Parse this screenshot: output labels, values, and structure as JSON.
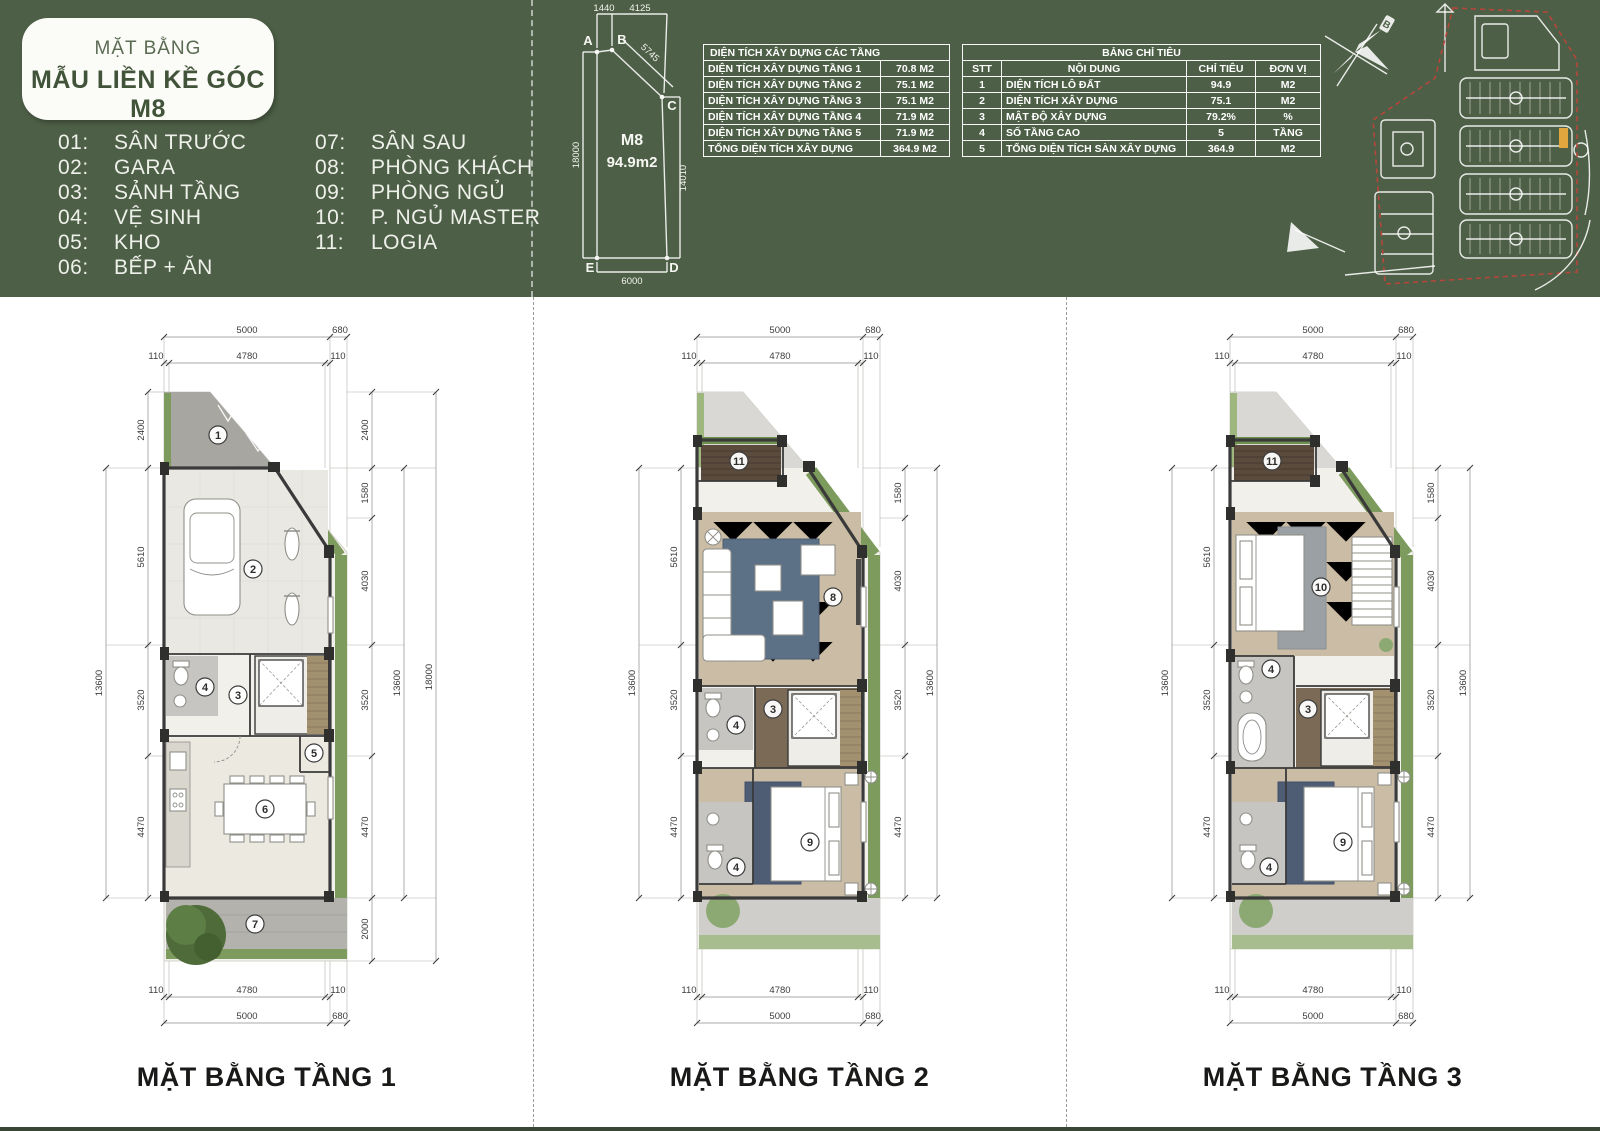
{
  "header": {
    "title_small": "MẶT BẰNG",
    "title_main": "MẪU LIỀN KỀ GÓC M8",
    "legend": [
      {
        "num": "01:",
        "label": "SÂN TRƯỚC"
      },
      {
        "num": "02:",
        "label": "GARA"
      },
      {
        "num": "03:",
        "label": "SẢNH TẦNG"
      },
      {
        "num": "04:",
        "label": "VỆ SINH"
      },
      {
        "num": "05:",
        "label": "KHO"
      },
      {
        "num": "06:",
        "label": "BẾP + ĂN"
      },
      {
        "num": "07:",
        "label": "SÂN SAU"
      },
      {
        "num": "08:",
        "label": "PHÒNG KHÁCH"
      },
      {
        "num": "09:",
        "label": "PHÒNG NGỦ"
      },
      {
        "num": "10:",
        "label": "P. NGỦ MASTER"
      },
      {
        "num": "11:",
        "label": "LOGIA"
      }
    ],
    "lot": {
      "code": "M8",
      "area": "94.9m2",
      "pA": "A",
      "pB": "B",
      "pC": "C",
      "pD": "D",
      "pE": "E",
      "d_top1": "1440",
      "d_top2": "4125",
      "d_diag": "5745",
      "d_left": "18000",
      "d_right": "14010",
      "d_bottom": "6000"
    },
    "area_table": {
      "title": "DIỆN TÍCH XÂY DỰNG CÁC TẦNG",
      "rows": [
        [
          "DIỆN TÍCH XÂY DỰNG TẦNG 1",
          "70.8 M2"
        ],
        [
          "DIỆN TÍCH XÂY DỰNG TẦNG 2",
          "75.1 M2"
        ],
        [
          "DIỆN TÍCH XÂY DỰNG TẦNG 3",
          "75.1 M2"
        ],
        [
          "DIỆN TÍCH XÂY DỰNG TẦNG 4",
          "71.9 M2"
        ],
        [
          "DIỆN TÍCH XÂY DỰNG TẦNG 5",
          "71.9 M2"
        ],
        [
          "TỔNG DIỆN TÍCH XÂY DỰNG",
          "364.9 M2"
        ]
      ]
    },
    "spec_table": {
      "title": "BẢNG CHỈ TIÊU",
      "columns": [
        "STT",
        "NỘI DUNG",
        "CHỈ TIÊU",
        "ĐƠN VỊ"
      ],
      "rows": [
        [
          "1",
          "DIỆN TÍCH LÔ ĐẤT",
          "94.9",
          "M2"
        ],
        [
          "2",
          "DIỆN TÍCH XÂY DỰNG",
          "75.1",
          "M2"
        ],
        [
          "3",
          "MẬT ĐỘ XÂY DỰNG",
          "79.2%",
          "%"
        ],
        [
          "4",
          "SỐ TẦNG CAO",
          "5",
          "TẦNG"
        ],
        [
          "5",
          "TỔNG DIỆN TÍCH SÀN XÂY DỰNG",
          "364.9",
          "M2"
        ]
      ]
    },
    "compass_label": "B"
  },
  "plans": [
    {
      "caption": "MẶT BẰNG TẦNG 1",
      "room_labels": [
        "1",
        "2",
        "3",
        "4",
        "5",
        "6",
        "7"
      ],
      "dims": {
        "top_outer": [
          "5000",
          "680"
        ],
        "top_inner": [
          "110",
          "4780",
          "110"
        ],
        "left_outer": [
          "13600"
        ],
        "left_inner": [
          "2400",
          "5610",
          "3520",
          "4470"
        ],
        "right_outer": [
          "13600",
          "18000"
        ],
        "right_inner": [
          "2400",
          "1580",
          "4030",
          "3520",
          "4470",
          "2000"
        ],
        "bottom_inner": [
          "110",
          "4780",
          "110"
        ],
        "bottom_outer": [
          "5000",
          "680"
        ]
      }
    },
    {
      "caption": "MẶT BẰNG TẦNG 2",
      "room_labels": [
        "11",
        "8",
        "3",
        "4",
        "9",
        "4"
      ],
      "dims": {
        "top_outer": [
          "5000",
          "680"
        ],
        "top_inner": [
          "110",
          "4780",
          "110"
        ],
        "left_outer": [
          "13600"
        ],
        "left_inner": [
          "5610",
          "3520",
          "4470"
        ],
        "right_outer": [
          "13600"
        ],
        "right_inner": [
          "1580",
          "4030",
          "3520",
          "4470"
        ],
        "bottom_inner": [
          "110",
          "4780",
          "110"
        ],
        "bottom_outer": [
          "5000",
          "680"
        ]
      }
    },
    {
      "caption": "MẶT BẰNG TẦNG 3",
      "room_labels": [
        "11",
        "10",
        "4",
        "3",
        "9",
        "4"
      ],
      "dims": {
        "top_outer": [
          "5000",
          "680"
        ],
        "top_inner": [
          "110",
          "4780",
          "110"
        ],
        "left_outer": [
          "13600"
        ],
        "left_inner": [
          "5610",
          "3520",
          "4470"
        ],
        "right_outer": [
          "13600"
        ],
        "right_inner": [
          "1580",
          "4030",
          "3520",
          "4470"
        ],
        "bottom_inner": [
          "110",
          "4780",
          "110"
        ],
        "bottom_outer": [
          "5000",
          "680"
        ]
      }
    }
  ],
  "colors": {
    "header_green": "#4d5f46",
    "table_border": "#ffffff",
    "grass": "#7c9b5c",
    "floor_tan": "#cbbda5",
    "rug_blue": "#5c7086",
    "stair_wood": "#7a6a56",
    "highlight_lot": "#e2a63f",
    "boundary_red": "#b5463b"
  }
}
